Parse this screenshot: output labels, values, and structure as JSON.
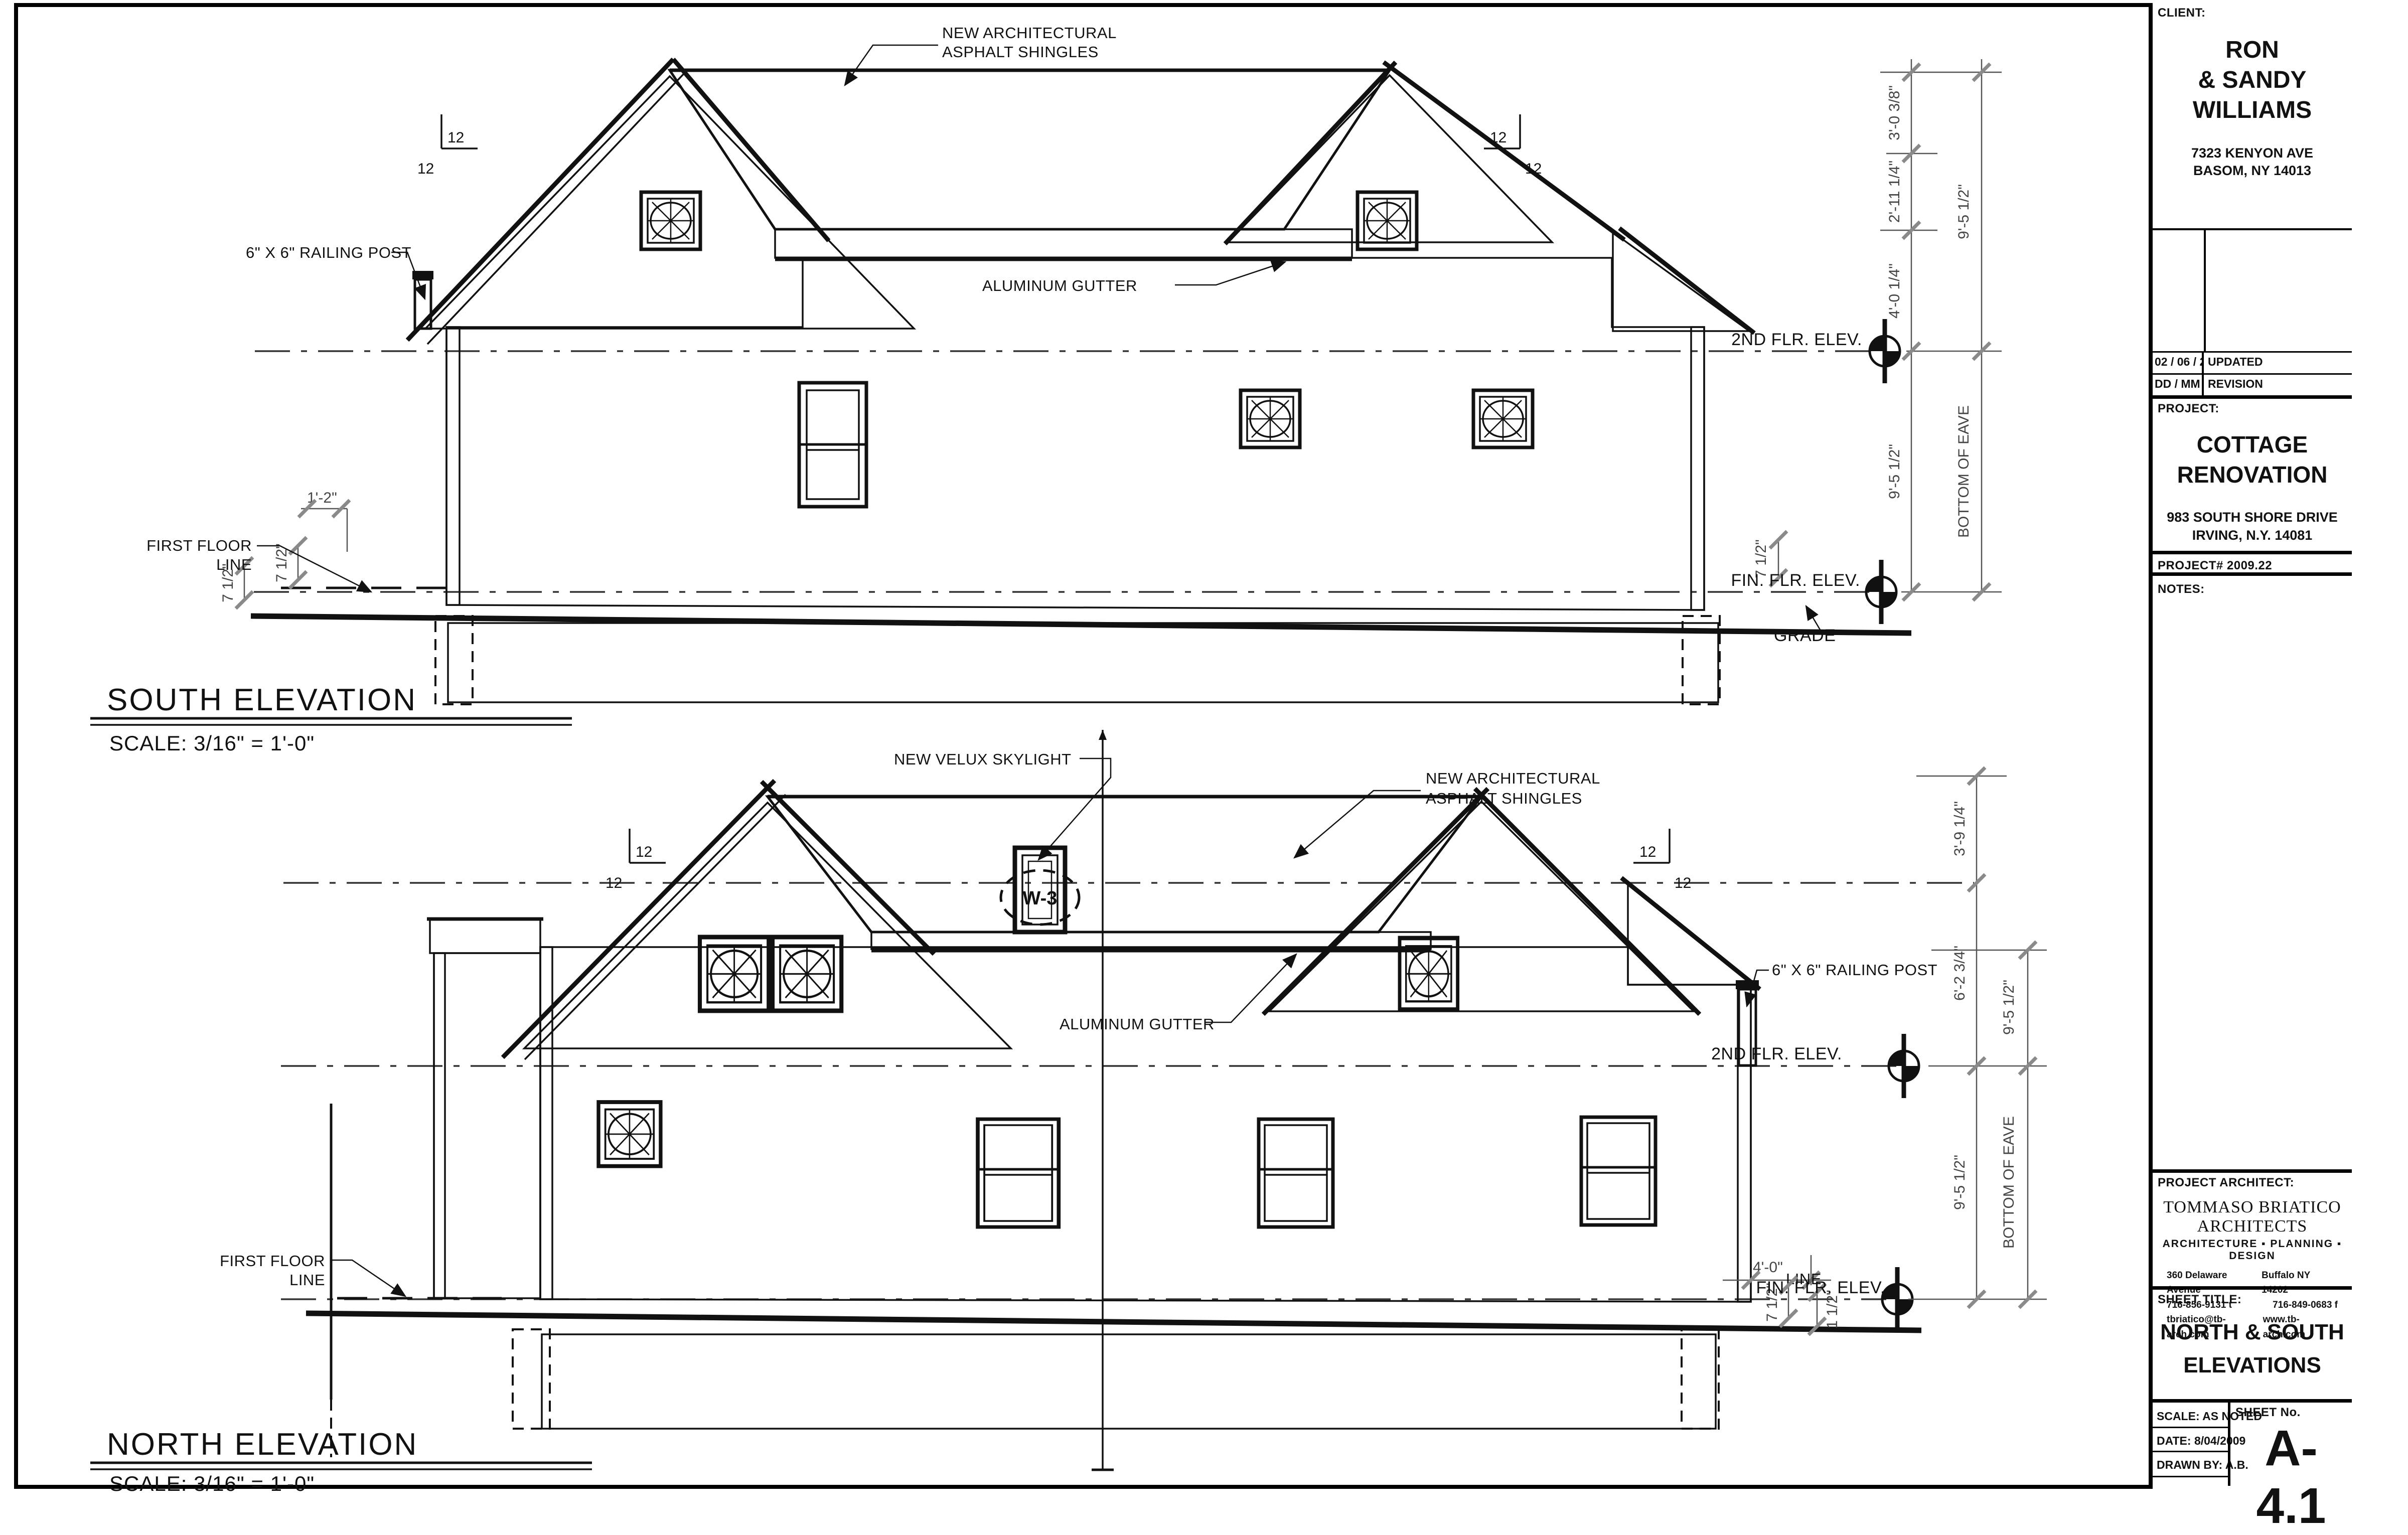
{
  "slope": "12",
  "south": {
    "title": "SOUTH ELEVATION",
    "scale": "SCALE: 3/16\" = 1'-0\"",
    "ann_shingles_l1": "NEW ARCHITECTURAL",
    "ann_shingles_l2": "ASPHALT SHINGLES",
    "ann_gutter": "ALUMINUM GUTTER",
    "ann_railing": "6\" X 6\" RAILING POST",
    "first_floor_l1": "FIRST FLOOR",
    "first_floor_l2": "LINE",
    "second_flr": "2ND FLR. ELEV.",
    "fin_flr": "FIN. FLR. ELEV.",
    "grade": "GRADE",
    "bottom_of_eave": "BOTTOM OF EAVE",
    "d1": "3'-0 3/8\"",
    "d2": "2'-11 1/4\"",
    "d3": "4'-0 1/4\"",
    "d95": "9'-5 1/2\"",
    "d712": "7 1/2\"",
    "d12": "1'-2\""
  },
  "north": {
    "title": "NORTH ELEVATION",
    "scale": "SCALE: 3/16\" = 1'-0\"",
    "ann_skylight": "NEW VELUX SKYLIGHT",
    "ann_shingles_l1": "NEW ARCHITECTURAL",
    "ann_shingles_l2": "ASPHALT SHINGLES",
    "ann_gutter": "ALUMINUM GUTTER",
    "ann_railing": "6\" X 6\" RAILING POST",
    "skylight_tag": "W-3",
    "first_floor_l1": "FIRST FLOOR",
    "first_floor_l2": "LINE",
    "second_flr": "2ND FLR. ELEV.",
    "fin_flr": "FIN. FLR. ELEV.",
    "line_lbl": "LINE",
    "bottom_of_eave": "BOTTOM OF EAVE",
    "d1": "3'-9 1/4\"",
    "d2": "6'-2 3/4\"",
    "d95": "9'-5 1/2\"",
    "d40": "4'-0\"",
    "d712": "7 1/2\"",
    "d112": "1 1/2\""
  },
  "titleblock": {
    "client_label": "CLIENT:",
    "client_name_l1": "RON",
    "client_name_l2": "& SANDY",
    "client_name_l3": "WILLIAMS",
    "client_addr_l1": "7323 KENYON AVE",
    "client_addr_l2": "BASOM, NY 14013",
    "rev_date": "02 / 06 / 2010",
    "rev_desc": "UPDATED",
    "rev_date_hdr": "DD / MM / YYYY",
    "rev_hdr": "REVISION",
    "project_label": "PROJECT:",
    "project_name_l1": "COTTAGE",
    "project_name_l2": "RENOVATION",
    "project_addr_l1": "983 SOUTH SHORE DRIVE",
    "project_addr_l2": "IRVING, N.Y. 14081",
    "project_no": "PROJECT# 2009.22",
    "notes_label": "NOTES:",
    "architect_label": "PROJECT ARCHITECT:",
    "architect_name": "TOMMASO BRIATICO ARCHITECTS",
    "architect_tagline": "ARCHITECTURE  ▪  PLANNING  ▪  DESIGN",
    "architect_addr_left": "360 Delaware Avenue",
    "architect_addr_right": "Buffalo NY    14202",
    "architect_tel": "716-856-9131 t",
    "architect_fax": "716-849-0683 f",
    "architect_email": "tbriatico@tb-arch.com",
    "architect_web": "www.tb-arch.com",
    "sheet_title_label": "SHEET TITLE:",
    "sheet_title_l1": "NORTH & SOUTH",
    "sheet_title_l2": "ELEVATIONS",
    "scale_row": "SCALE: AS NOTED",
    "date_row": "DATE: 8/04/2009",
    "drawn_row": "DRAWN BY: A.B.",
    "sheet_no_label": "SHEET No.",
    "sheet_no": "A-4.1"
  }
}
